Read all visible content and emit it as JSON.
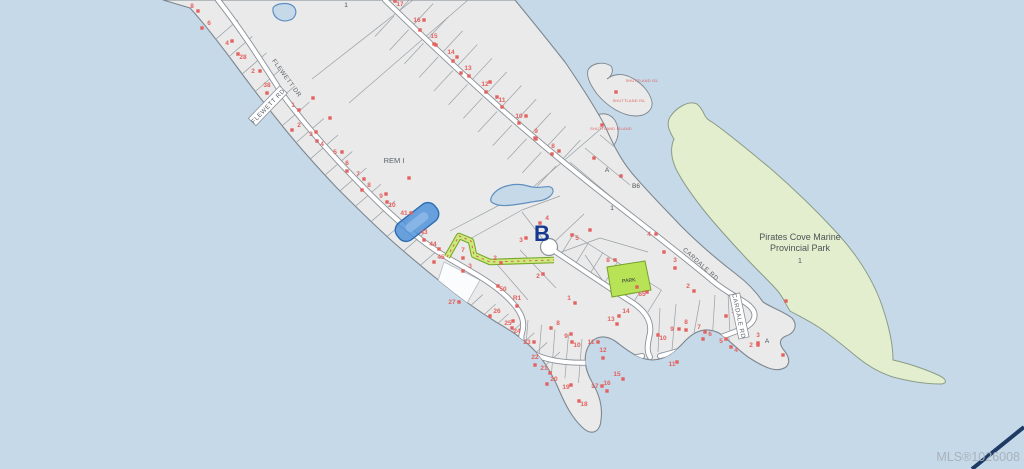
{
  "map": {
    "colors": {
      "water": "#c6d9e9",
      "land": "#e9eae9",
      "land_stroke": "#7d868e",
      "park": "#e2eecd",
      "park_stroke": "#8b9b86",
      "road_fill": "#ffffff",
      "road_casing": "#8a9199",
      "lot_line": "#9aa0a6",
      "lot_red": "#e2625f",
      "trail_fill": "#cdea7c",
      "trail_stroke": "#76a629",
      "trail_dash": "#d96455",
      "park_lot_fill": "#b8e356",
      "park_lot_stroke": "#74a32b",
      "marker_fill": "#4a90d9",
      "marker_stroke": "#2e6cb0",
      "marker_inner": "#8db9e6",
      "navy": "#16388e",
      "label_gray": "#5c636a",
      "pond_stroke": "#5f8fc0",
      "mls_gray": "#a9b2ba",
      "corner_line": "#1d3b63",
      "white_parcel": "#fbfcfd"
    },
    "street_labels": [
      {
        "text": "FLEWETT DR",
        "x": 287,
        "y": 78,
        "rot": 54,
        "boxed": false
      },
      {
        "text": "FLEWETT RD",
        "x": 268,
        "y": 106,
        "rot": -46,
        "boxed": true
      },
      {
        "text": "CARDALE RD",
        "x": 701,
        "y": 264,
        "rot": 42,
        "boxed": false
      },
      {
        "text": "CARDALE RD",
        "x": 739,
        "y": 316,
        "rot": 78,
        "boxed": true
      }
    ],
    "area_labels": [
      {
        "text": "REM I",
        "x": 394,
        "y": 163,
        "size": 7.5,
        "color": "#5c636a"
      },
      {
        "text": "Pirates Cove Marine",
        "x": 800,
        "y": 240,
        "size": 9,
        "color": "#4d5358"
      },
      {
        "text": "Provincial Park",
        "x": 800,
        "y": 251,
        "size": 9,
        "color": "#4d5358"
      },
      {
        "text": "1",
        "x": 800,
        "y": 263,
        "size": 7,
        "color": "#4d5358"
      },
      {
        "text": "PARK",
        "x": 629,
        "y": 282,
        "size": 5.2,
        "color": "#2f3235",
        "rot": -6
      }
    ],
    "big_label": {
      "text": "B",
      "x": 542,
      "y": 241
    },
    "island_labels": [
      {
        "text": "SHUTTLAND ISL",
        "x": 642,
        "y": 82
      },
      {
        "text": "SHUTTLAND ISL",
        "x": 629,
        "y": 102
      },
      {
        "text": "SHUTTLAND ISLAND",
        "x": 611,
        "y": 130
      }
    ],
    "watermark": {
      "mls": "MLS®1026008"
    },
    "lot_numbers": [
      [
        "8",
        192,
        8
      ],
      [
        "6",
        209,
        25
      ],
      [
        "4",
        227,
        45
      ],
      [
        "28",
        243,
        59
      ],
      [
        "2",
        253,
        73
      ],
      [
        "38",
        267,
        87
      ],
      [
        "1",
        293,
        107
      ],
      [
        "2",
        299,
        127
      ],
      [
        "3",
        311,
        136
      ],
      [
        "4",
        322,
        146
      ],
      [
        "5",
        335,
        154
      ],
      [
        "6",
        347,
        165
      ],
      [
        "7",
        358,
        176
      ],
      [
        "8",
        369,
        187
      ],
      [
        "9",
        381,
        198
      ],
      [
        "10",
        392,
        207
      ],
      [
        "41",
        404,
        215
      ],
      [
        "43",
        424,
        234
      ],
      [
        "44",
        433,
        246
      ],
      [
        "45",
        441,
        259
      ],
      [
        "1",
        346,
        7,
        "g"
      ],
      [
        "17",
        400,
        6
      ],
      [
        "16",
        417,
        22
      ],
      [
        "15",
        434,
        38
      ],
      [
        "14",
        451,
        54
      ],
      [
        "13",
        468,
        70
      ],
      [
        "12",
        485,
        86
      ],
      [
        "11",
        502,
        102
      ],
      [
        "10",
        519,
        118
      ],
      [
        "9",
        536,
        133
      ],
      [
        "8",
        553,
        148
      ],
      [
        "A",
        607,
        172,
        "g"
      ],
      [
        "B6",
        636,
        188,
        "g"
      ],
      [
        "1",
        612,
        210,
        "g"
      ],
      [
        "4",
        649,
        236
      ],
      [
        "3",
        675,
        262
      ],
      [
        "2",
        688,
        288
      ],
      [
        "4",
        547,
        220
      ],
      [
        "3",
        521,
        242
      ],
      [
        "5",
        577,
        240
      ],
      [
        "8",
        608,
        262
      ],
      [
        "7",
        463,
        252
      ],
      [
        "2",
        495,
        260
      ],
      [
        "3",
        470,
        268
      ],
      [
        "2",
        538,
        278
      ],
      [
        "50",
        503,
        291
      ],
      [
        "27",
        452,
        304
      ],
      [
        "R1",
        517,
        300
      ],
      [
        "1",
        569,
        300
      ],
      [
        "26",
        497,
        313
      ],
      [
        "25",
        508,
        325
      ],
      [
        "24",
        517,
        333
      ],
      [
        "23",
        527,
        344
      ],
      [
        "22",
        535,
        359
      ],
      [
        "21",
        544,
        370
      ],
      [
        "20",
        554,
        381
      ],
      [
        "19",
        566,
        389
      ],
      [
        "18",
        584,
        406
      ],
      [
        "17",
        595,
        388
      ],
      [
        "16",
        607,
        385
      ],
      [
        "15",
        617,
        376
      ],
      [
        "8",
        558,
        325
      ],
      [
        "9",
        566,
        338
      ],
      [
        "10",
        577,
        347
      ],
      [
        "11",
        591,
        344
      ],
      [
        "12",
        603,
        352
      ],
      [
        "13",
        611,
        321
      ],
      [
        "14",
        626,
        313
      ],
      [
        "11",
        672,
        366
      ],
      [
        "10",
        663,
        340
      ],
      [
        "9",
        672,
        331
      ],
      [
        "8",
        686,
        324
      ],
      [
        "7",
        699,
        329
      ],
      [
        "6",
        710,
        336
      ],
      [
        "5",
        721,
        343
      ],
      [
        "4",
        736,
        352
      ],
      [
        "2",
        751,
        347
      ],
      [
        "3",
        758,
        337
      ],
      [
        "A",
        767,
        343,
        "g"
      ],
      [
        "1",
        733,
        313
      ],
      [
        "65",
        642,
        296
      ]
    ],
    "extra_dots": [
      [
        409,
        178
      ],
      [
        616,
        92
      ],
      [
        602,
        125
      ],
      [
        786,
        301
      ],
      [
        783,
        355
      ],
      [
        637,
        287
      ],
      [
        420,
        30
      ],
      [
        436,
        45
      ],
      [
        453,
        61
      ],
      [
        469,
        76
      ],
      [
        486,
        92
      ],
      [
        502,
        107
      ],
      [
        519,
        123
      ],
      [
        535,
        138
      ],
      [
        552,
        154
      ],
      [
        594,
        158
      ],
      [
        621,
        176
      ],
      [
        590,
        230
      ],
      [
        664,
        252
      ],
      [
        330,
        118
      ],
      [
        313,
        98
      ]
    ]
  }
}
